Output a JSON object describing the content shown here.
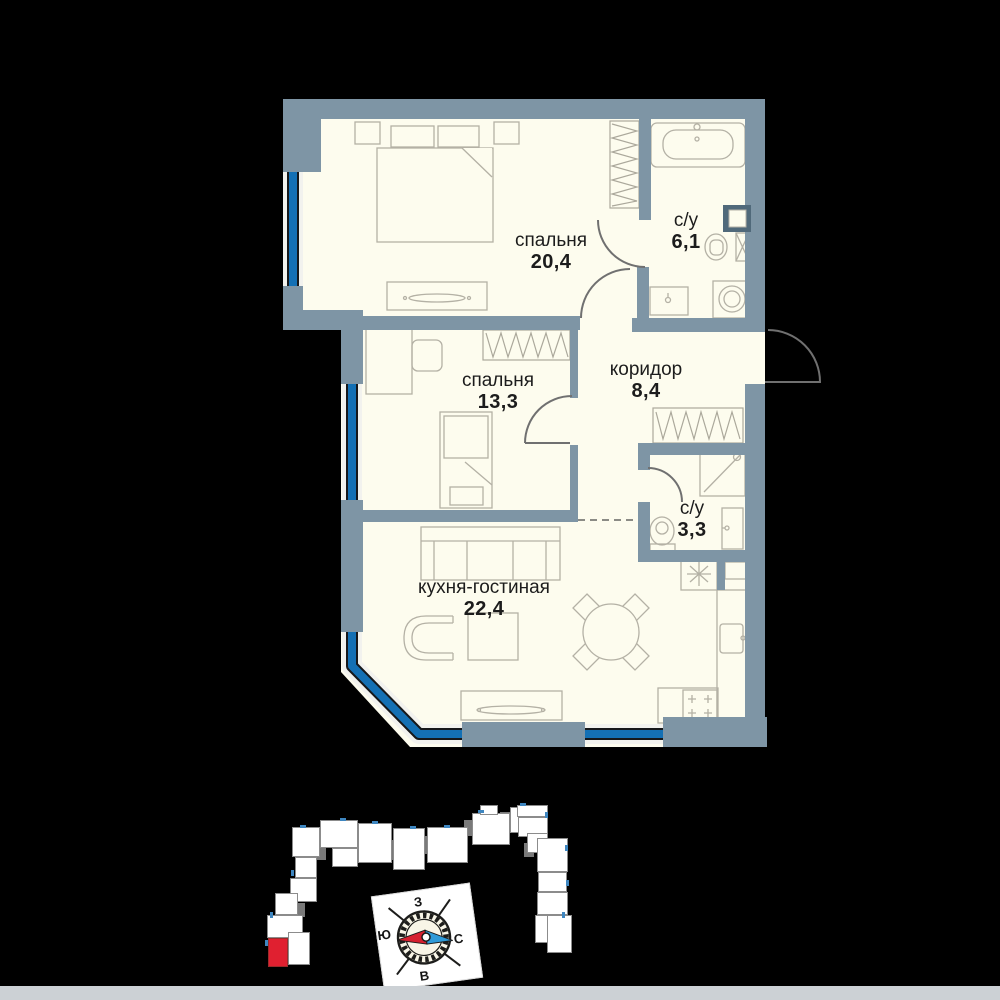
{
  "floor_plan": {
    "rooms": [
      {
        "name": "спальня",
        "area": "20,4"
      },
      {
        "name": "с/у",
        "area": "6,1"
      },
      {
        "name": "спальня",
        "area": "13,3"
      },
      {
        "name": "коридор",
        "area": "8,4"
      },
      {
        "name": "с/у",
        "area": "3,3"
      },
      {
        "name": "кухня-гостиная",
        "area": "22,4"
      }
    ]
  },
  "compass": {
    "labels": {
      "north": "С",
      "south": "Ю",
      "west": "З",
      "east": "В"
    }
  },
  "colors": {
    "background": "#000000",
    "wall": "#7E95A5",
    "floor": "#FDFCEE",
    "window_glass": "#1470B4",
    "furniture_line": "#B4B1A5",
    "site_highlight": "#E02030",
    "needle_red": "#D6202F",
    "needle_blue": "#2F9AD8"
  }
}
